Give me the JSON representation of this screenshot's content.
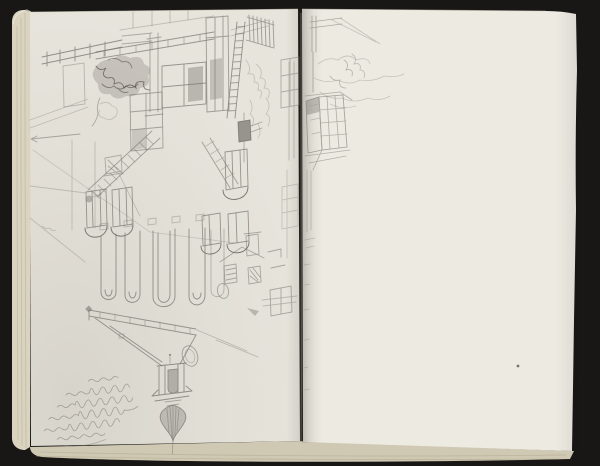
{
  "scene": {
    "subject": "open-sketchbook-photograph",
    "left_page": "upside-down pencil sketch of courtyard houses with shuttered windows, ladder, foliage and church tower with onion spire; faint handwritten inscription",
    "right_page": "mostly blank page; light sketch of bay window and foliage continues from gutter"
  },
  "colors": {
    "background": "#181715",
    "page_left": "#e7e4dc",
    "page_right": "#edeae2",
    "page_edge": "#d9d3c0",
    "page_edge_bottom": "#cfc8b2",
    "page_edge_line": "#b0a88e",
    "pencil": "#75736c",
    "pencil_dark": "#45433e",
    "pencil_light": "#a3a199",
    "gutter_line": "#90887a"
  }
}
